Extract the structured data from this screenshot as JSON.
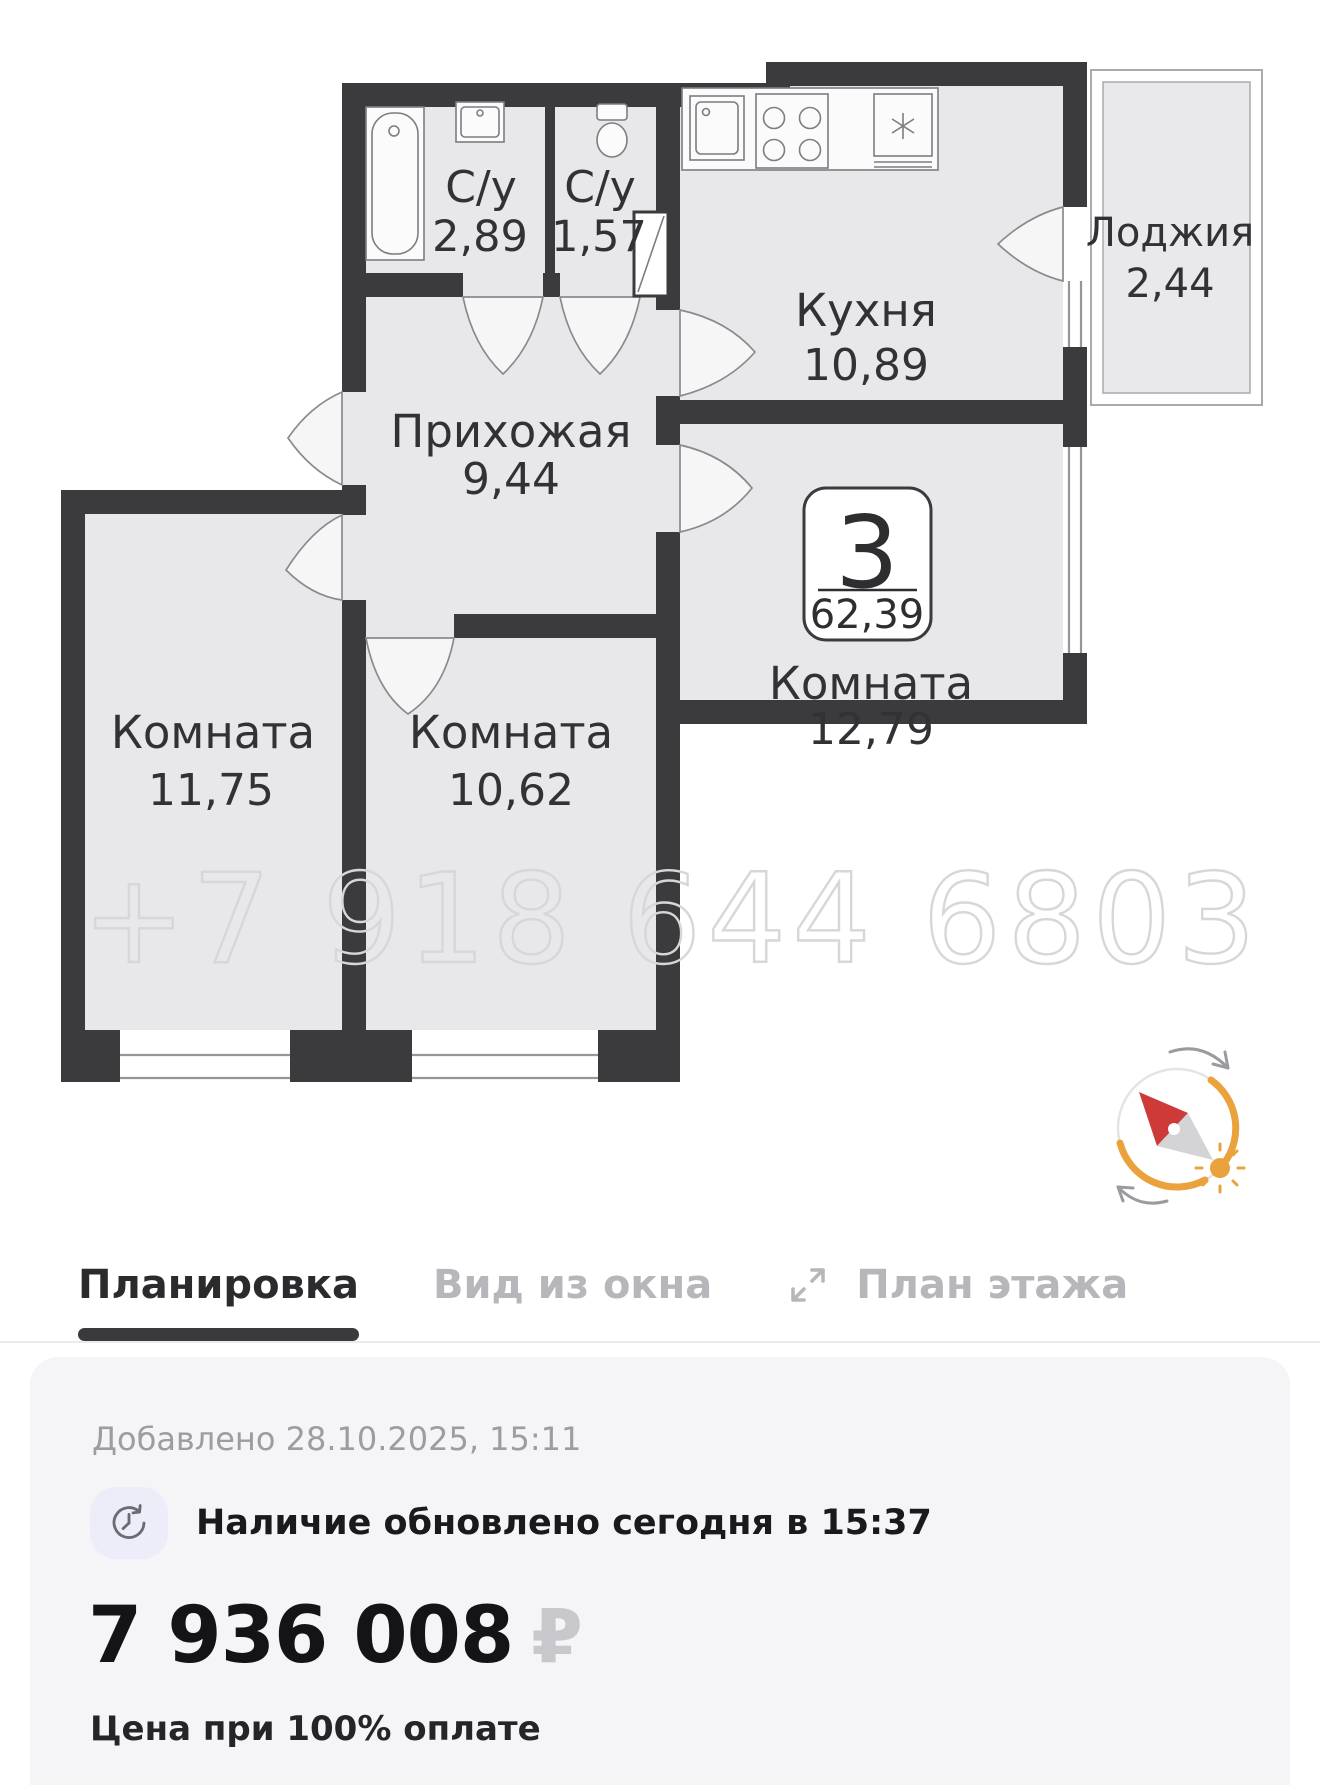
{
  "floor_plan": {
    "watermark": "+7 918 644 6803",
    "badge": {
      "rooms_count": "3",
      "total_area": "62,39"
    },
    "rooms": [
      {
        "name": "С/у",
        "area": "2,89"
      },
      {
        "name": "С/у",
        "area": "1,57"
      },
      {
        "name": "Кухня",
        "area": "10,89"
      },
      {
        "name": "Лоджия",
        "area": "2,44"
      },
      {
        "name": "Прихожая",
        "area": "9,44"
      },
      {
        "name": "Комната",
        "area": "11,75"
      },
      {
        "name": "Комната",
        "area": "10,62"
      },
      {
        "name": "Комната",
        "area": "12,79"
      }
    ],
    "icons": [
      "bathtub-icon",
      "sink-icon",
      "toilet-icon",
      "kitchen-sink-icon",
      "stove-icon",
      "fridge-icon",
      "vent-shaft-icon",
      "compass-sun-icon"
    ]
  },
  "tabs": [
    {
      "label": "Планировка",
      "active": true
    },
    {
      "label": "Вид из окна",
      "active": false
    },
    {
      "label": "План этажа",
      "active": false
    }
  ],
  "listing": {
    "added": "Добавлено 28.10.2025, 15:11",
    "availability": "Наличие обновлено сегодня в 15:37",
    "price": "7 936 008",
    "currency": "₽",
    "price_note": "Цена при 100% оплате"
  },
  "colors": {
    "wall": "#3b3b3d",
    "room_fill": "#e8e8ea",
    "active_tab": "#2b2b2e",
    "inactive_tab": "#b7b7bb",
    "tab_underline": "#3a3a3c",
    "card_bg": "#f5f5f7",
    "muted_text": "#9c9ca2",
    "price_text": "#141418",
    "currency_muted": "#c7c7cc",
    "compass_orange": "#eaa23c",
    "needle_red": "#cd3a38",
    "watermark": "#d7d7d9",
    "badge_bg": "#ffffff"
  }
}
